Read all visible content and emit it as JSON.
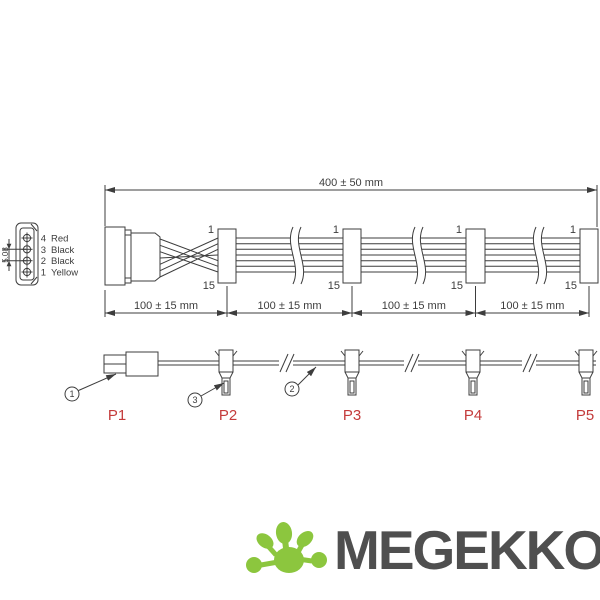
{
  "colors": {
    "drawing_line": "#3d3d3d",
    "port_label_red": "#c43b3b",
    "logo_text_gray": "#4f4f4f",
    "logo_green": "#8cc63e",
    "background": "#ffffff"
  },
  "drawing": {
    "overall_dim_label": "400 ± 50 mm",
    "segment_dim_labels": [
      "100 ± 15 mm",
      "100 ± 15 mm",
      "100 ± 15 mm",
      "100 ± 15 mm"
    ],
    "pin_pitch_label": "5.08",
    "molex_pins": [
      {
        "num": "4",
        "wire": "Red"
      },
      {
        "num": "3",
        "wire": "Black"
      },
      {
        "num": "2",
        "wire": "Black"
      },
      {
        "num": "1",
        "wire": "Yellow"
      }
    ],
    "fan_pin_first": "1",
    "fan_pin_last": "15",
    "callouts": {
      "molex": "1",
      "cable": "2",
      "fan": "3"
    },
    "port_labels": [
      "P1",
      "P2",
      "P3",
      "P4",
      "P5"
    ]
  },
  "logo": {
    "text": "MEGEKKO"
  }
}
